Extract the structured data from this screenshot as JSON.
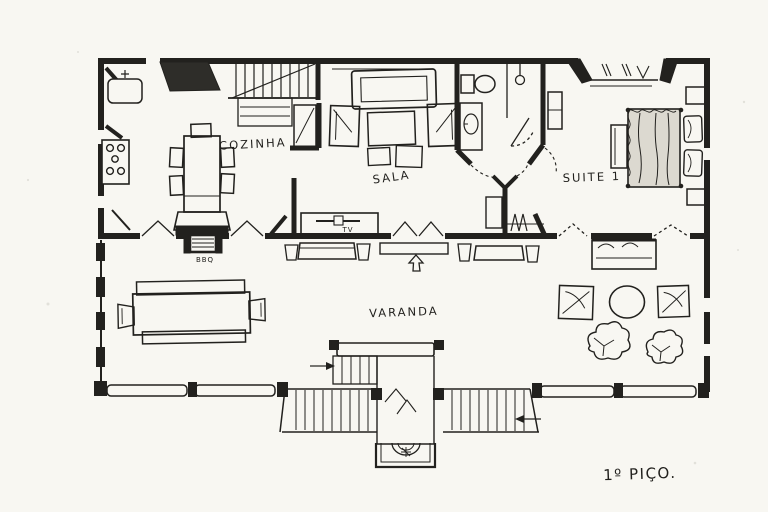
{
  "plan": {
    "title": "1º PIÇO.",
    "rooms": [
      {
        "name": "cozinha",
        "label": "COZINHA"
      },
      {
        "name": "sala",
        "label": "SALA"
      },
      {
        "name": "suite-1",
        "label": "SUITE 1"
      },
      {
        "name": "varanda",
        "label": "VARANDA"
      }
    ],
    "annotations": [
      {
        "name": "bbq-grill",
        "label": "BBQ"
      },
      {
        "name": "tv",
        "label": "TV"
      }
    ],
    "colors": {
      "ink": "#22211e",
      "paper": "#f8f7f2",
      "bed_shade": "#dcd9d0",
      "counter_fill": "#2e2d29"
    }
  }
}
